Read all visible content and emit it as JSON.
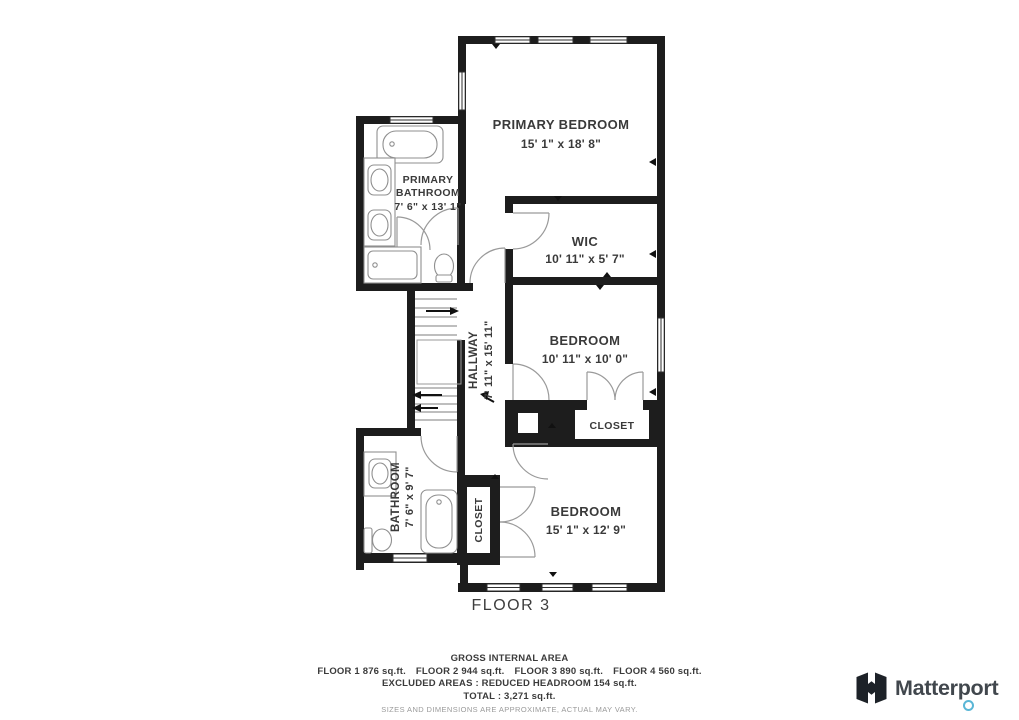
{
  "plan": {
    "floor_label": "FLOOR 3",
    "rooms": {
      "primary_bedroom": {
        "name": "PRIMARY BEDROOM",
        "dims": "15' 1\" x 18' 8\""
      },
      "primary_bathroom": {
        "name_line1": "PRIMARY",
        "name_line2": "BATHROOM",
        "dims": "7' 6\" x 13' 1\""
      },
      "wic": {
        "name": "WIC",
        "dims": "10' 11\" x 5' 7\""
      },
      "hallway": {
        "name": "HALLWAY",
        "dims": "7' 11\" x 15' 11\""
      },
      "bedroom_mid": {
        "name": "BEDROOM",
        "dims": "10' 11\" x 10' 0\""
      },
      "closet_mid": {
        "name": "CLOSET"
      },
      "bathroom": {
        "name": "BATHROOM",
        "dims": "7' 6\" x 9' 7\""
      },
      "closet_bottom": {
        "name": "CLOSET"
      },
      "bedroom_bottom": {
        "name": "BEDROOM",
        "dims": "15' 1\" x 12' 9\""
      }
    }
  },
  "footer": {
    "title": "GROSS INTERNAL AREA",
    "floors": [
      "FLOOR 1 876 sq.ft.",
      "FLOOR 2 944 sq.ft.",
      "FLOOR 3 890 sq.ft.",
      "FLOOR 4 560 sq.ft."
    ],
    "excluded_line": "EXCLUDED AREAS :  REDUCED HEADROOM 154 sq.ft.",
    "total_line": "TOTAL :  3,271 sq.ft.",
    "disclaimer": "SIZES AND DIMENSIONS ARE APPROXIMATE, ACTUAL MAY VARY."
  },
  "branding": {
    "logo_text": "Matterport"
  },
  "colors": {
    "wall": "#1d1d1d",
    "fixture": "#8f8f8f",
    "door": "#9a9a9a",
    "accent_blue": "#5ab6d6"
  }
}
